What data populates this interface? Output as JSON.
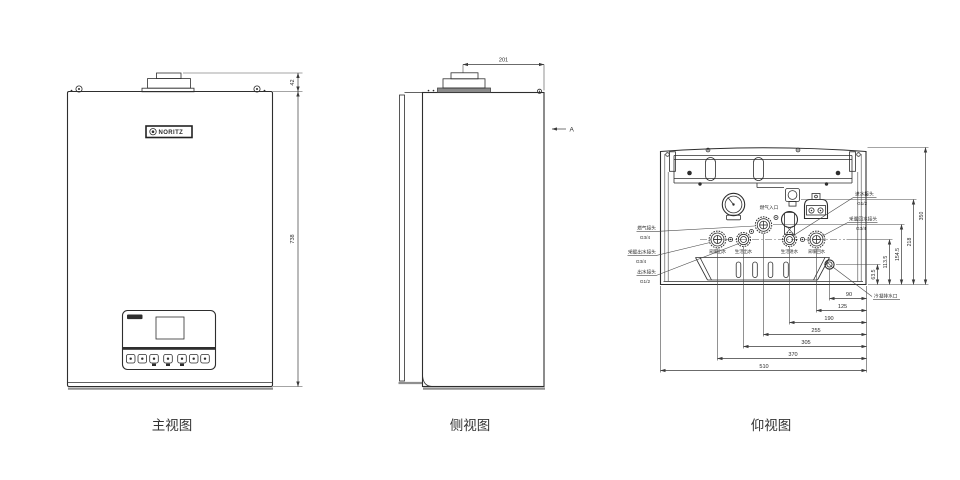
{
  "views": {
    "front": {
      "title": "主视图",
      "logo": "NORITZ",
      "dim_flue_height": "42",
      "dim_body_height": "738"
    },
    "side": {
      "title": "侧视图",
      "dim_flue_to_front": "201",
      "view_arrow_label": "A"
    },
    "bottom": {
      "title": "仰视图",
      "gas_inlet_label": "燃气入口",
      "callouts_left": [
        {
          "name": "燃气接头",
          "size": "G3/4"
        },
        {
          "name": "采暖出水接头",
          "size": "G3/4"
        },
        {
          "name": "出水接头",
          "size": "G1/2"
        }
      ],
      "callouts_right": [
        {
          "name": "进水接头",
          "size": "G1/2"
        },
        {
          "name": "采暖回水接头",
          "size": "G3/4"
        }
      ],
      "drain_label": "冷凝排水口",
      "port_labels": [
        "采暖出水",
        "生活出水",
        "生活进水",
        "采暖回水"
      ],
      "dims_vertical": [
        "63.5",
        "113.5",
        "154.5",
        "218",
        "350"
      ],
      "dims_horizontal": [
        "90",
        "125",
        "190",
        "255",
        "305",
        "370",
        "510"
      ]
    }
  },
  "colors": {
    "line": "#2e2e2e",
    "shadow": "#8f8f8f",
    "background": "#ffffff"
  }
}
